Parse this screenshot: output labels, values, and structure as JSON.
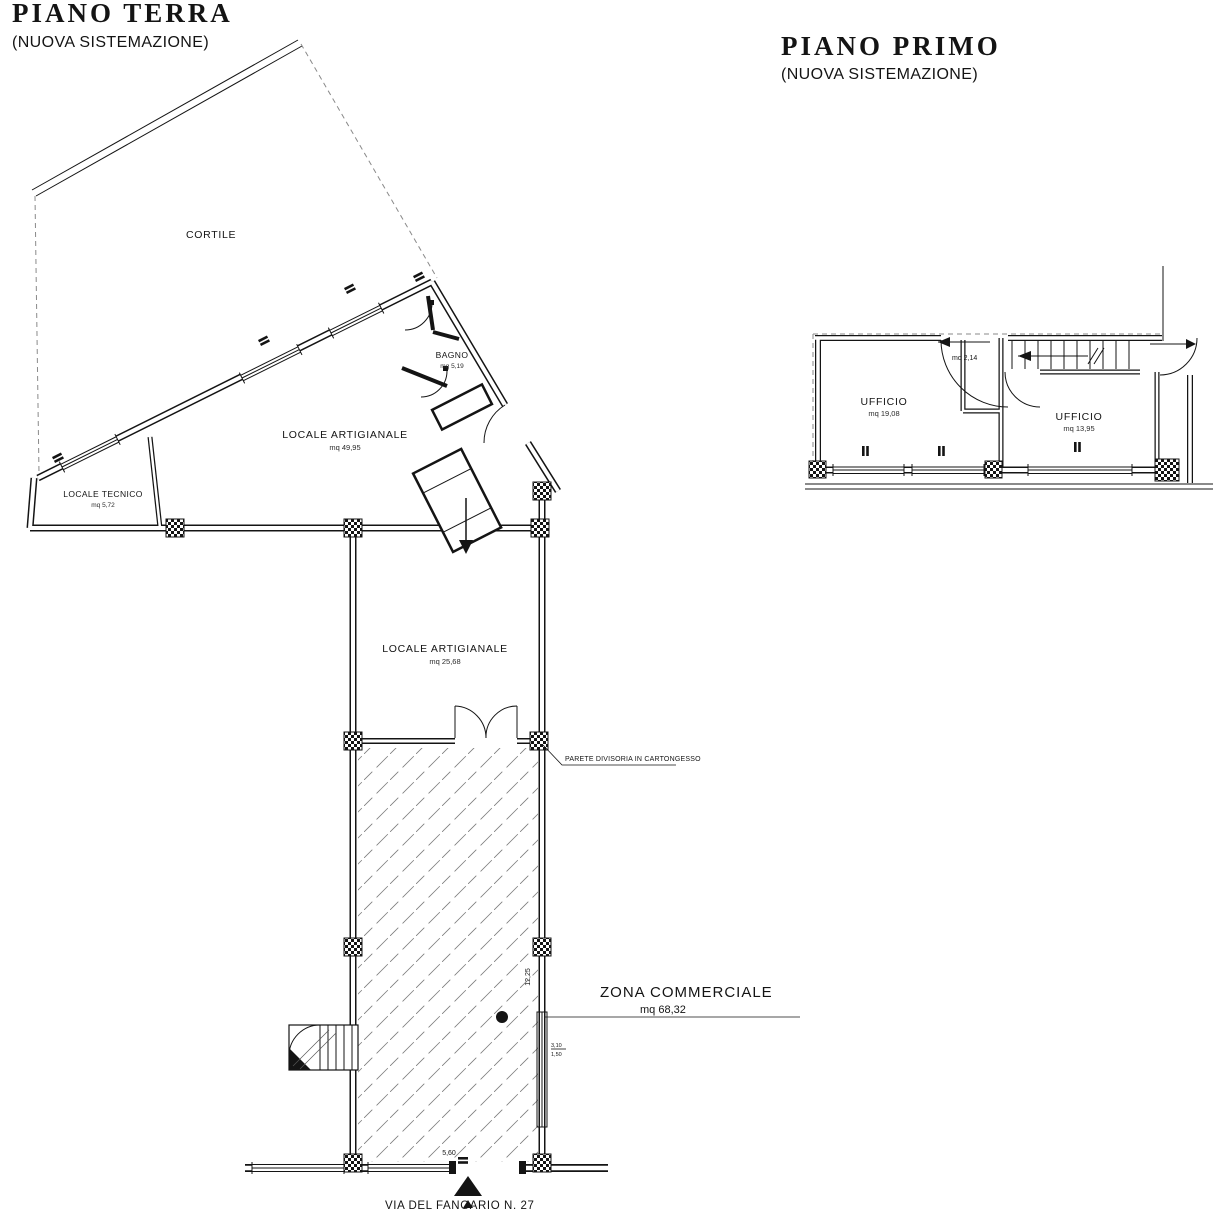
{
  "ground_floor": {
    "title": "PIANO TERRA",
    "subtitle": "(NUOVA SISTEMAZIONE)",
    "cortile_label": "CORTILE",
    "bagno": {
      "name": "BAGNO",
      "area": "mq 5,19"
    },
    "artigianale_wing": {
      "name": "LOCALE ARTIGIANALE",
      "area": "mq 49,95"
    },
    "tecnico": {
      "name": "LOCALE TECNICO",
      "area": "mq 5,72"
    },
    "artigianale_mid": {
      "name": "LOCALE ARTIGIANALE",
      "area": "mq 25,68"
    },
    "zona_commerciale": {
      "name": "ZONA COMMERCIALE",
      "area": "mq 68,32"
    },
    "partition_note": "PARETE DIVISORIA IN CARTONGESSO",
    "street_label": "VIA DEL FANGARIO N. 27",
    "dim_width": "5,60",
    "dim_depth": "12,25",
    "dim_window_top": "3,10",
    "dim_window_bottom": "1,50"
  },
  "first_floor": {
    "title": "PIANO PRIMO",
    "subtitle": "(NUOVA SISTEMAZIONE)",
    "ufficio_left": {
      "name": "UFFICIO",
      "area": "mq 19,08"
    },
    "ufficio_right": {
      "name": "UFFICIO",
      "area": "mq 13,95"
    },
    "disimpegno_area": "mq 2,14"
  }
}
